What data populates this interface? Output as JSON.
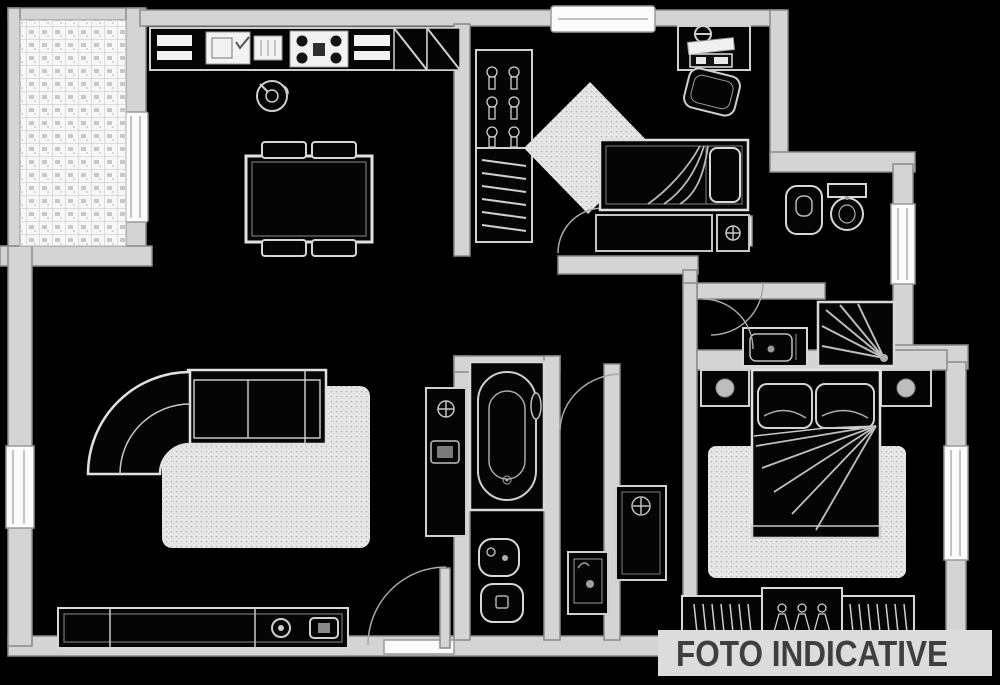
{
  "watermark": {
    "text": "FOTO INDICATIVE"
  },
  "colors": {
    "background": "#000000",
    "wall_fill": "#d4d4d4",
    "wall_outline": "#8a8a8a",
    "fixture_fill": "#050505",
    "fixture_outline": "#d8d8d8",
    "detail_line": "#b8b8b8",
    "window_fill": "#fbfbfb",
    "rug_fill": "#e8e8e8",
    "tile_fill": "#f7f7f7",
    "band_bg": "#dcdcdc",
    "watermark_text": "#3f3f3f"
  },
  "plan": {
    "type": "apartment-floor-plan",
    "icons": [
      "tile-grid",
      "kitchen-sink-icon",
      "drainer-icon",
      "stove-burners-icon",
      "corner-cabinet-icon",
      "kettle-icon",
      "dining-table-icon",
      "chair-icon",
      "closet-hanger-icon",
      "shelf-lines-icon",
      "door-mat",
      "desk-icon",
      "desk-lamp-icon",
      "office-chair-icon",
      "single-bed-icon",
      "pillow-icon",
      "blanket-fold-lines",
      "nightstand-icon",
      "flower-icon",
      "bidet-icon",
      "toilet-icon",
      "radiator-icon",
      "washbasin-icon",
      "shower-spray-icon",
      "bathtub-icon",
      "washing-machine-icon",
      "corner-sofa-icon",
      "rug-texture",
      "tv-icon",
      "media-player-icon",
      "sideboard-icon",
      "door-swing-arc",
      "door-leaf",
      "window-frame",
      "double-bed-icon",
      "table-lamp-icon",
      "wardrobe-hanger-icon",
      "entrance-door"
    ]
  }
}
